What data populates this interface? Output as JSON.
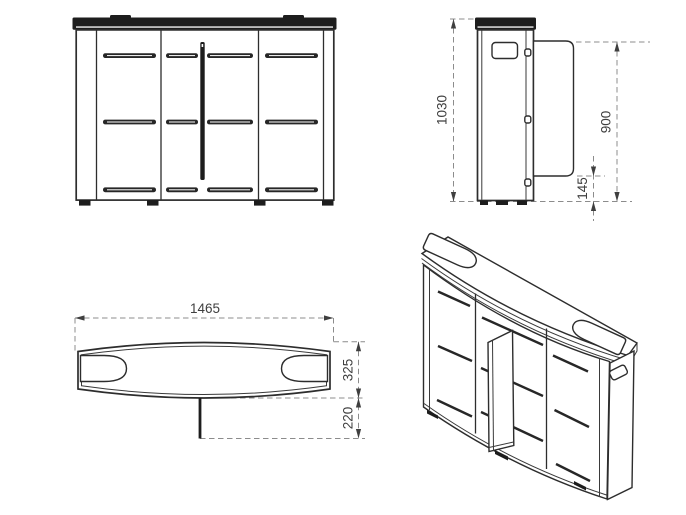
{
  "drawing": {
    "type": "furniture-technical-drawing",
    "colors": {
      "background": "#ffffff",
      "outline": "#2d2d2d",
      "dark_fill": "#1d1d1d",
      "dimension_line": "#8c8c8c",
      "dimension_text": "#3f3f3f"
    },
    "views": {
      "front": {
        "label": "front-elevation"
      },
      "side": {
        "label": "side-elevation",
        "dims": {
          "total_height": "1030",
          "door_top_from_floor": "900",
          "door_bottom_from_floor": "145"
        }
      },
      "plan": {
        "label": "top-plan",
        "dims": {
          "total_width": "1465",
          "depth": "325",
          "door_open_depth": "220"
        }
      },
      "iso": {
        "label": "isometric-view"
      }
    }
  }
}
